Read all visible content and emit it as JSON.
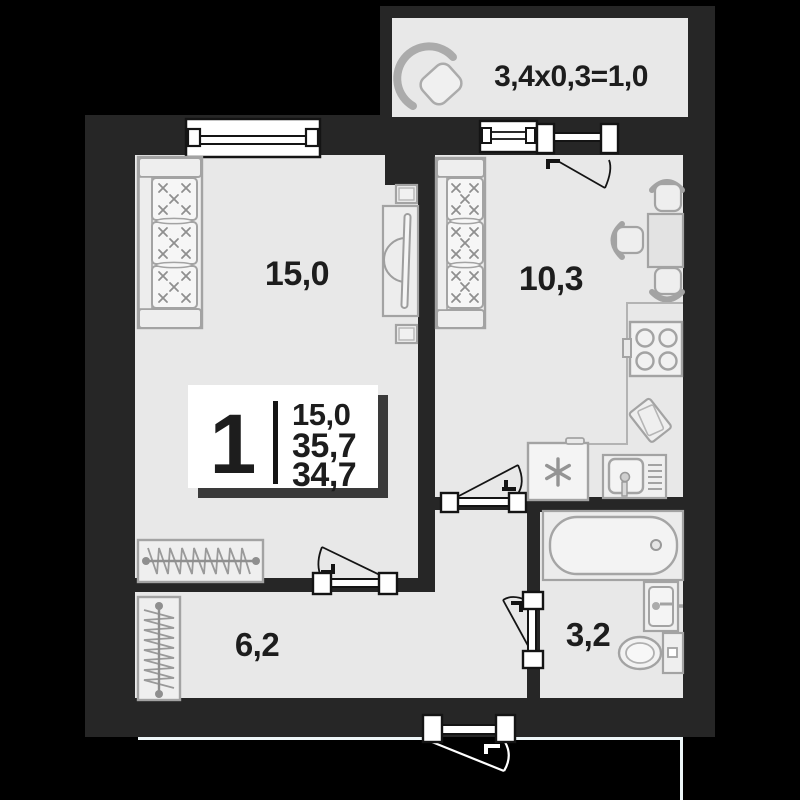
{
  "plan": {
    "type": "apartment-floor-plan",
    "labels": {
      "living": "15,0",
      "kitchen": "10,3",
      "hall": "6,2",
      "bath": "3,2",
      "balcony": "3,4x0,3=1,0"
    },
    "info": {
      "number": "1",
      "values": [
        "15,0",
        "35,7",
        "34,7"
      ]
    },
    "colors": {
      "background": "#000000",
      "wall": "#262626",
      "floor": "#e8e8e8",
      "furniture_stroke": "#a3a3a3",
      "text": "#1d1d1d",
      "frame_stroke": "#141414",
      "boundary_line": "#eef6f8",
      "info_box_bg": "#ffffff",
      "info_box_shadow": "#3a3a3a"
    }
  }
}
